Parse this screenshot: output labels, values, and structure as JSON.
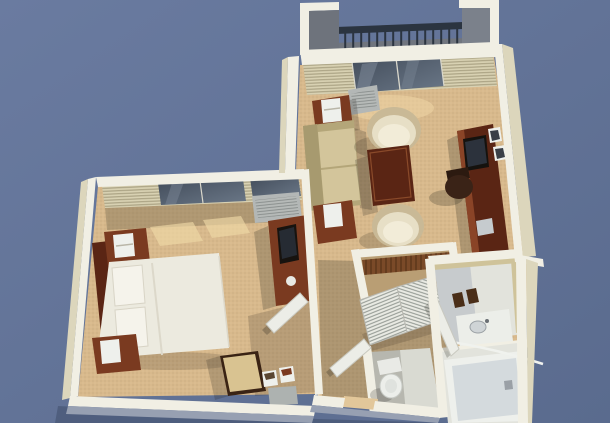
{
  "scene": {
    "type": "3d-floorplan-render",
    "description": "Bird's-eye 3D rendering of a one-bedroom suite floor plan on a blue-gray background",
    "rooms": [
      {
        "name": "balcony",
        "items": [
          "metal railing",
          "side pillars"
        ]
      },
      {
        "name": "living-room",
        "items": [
          "sofa",
          "end table with lamp (x2)",
          "barrel chair (x2)",
          "wood table",
          "media console",
          "tv",
          "desk chair",
          "wall art (x2)",
          "ptac unit",
          "sliding glass door",
          "vertical blinds"
        ]
      },
      {
        "name": "bedroom",
        "items": [
          "bed with white bedding",
          "pillows",
          "headboard",
          "nightstand with lamp (x2)",
          "dresser",
          "tv",
          "ice bucket",
          "ptac unit",
          "windows with blinds",
          "luggage bench",
          "bins",
          "door"
        ]
      },
      {
        "name": "closet",
        "items": [
          "louvered bifold doors",
          "shelf with hangers"
        ]
      },
      {
        "name": "hallway",
        "items": [
          "entry door"
        ]
      },
      {
        "name": "bathroom",
        "items": [
          "vanity counter",
          "sink",
          "bath mats",
          "shower rod",
          "bathtub",
          "tub faucet",
          "toilet",
          "door"
        ]
      }
    ],
    "palette": {
      "skyTop": "#6A7BA0",
      "skyBottom": "#5A6B8E",
      "carpet": "#D8B98C",
      "wallWhite": "#F1EFE4",
      "wallCream": "#DCD6BC",
      "wallShadowBlue": "#97A0B2",
      "wallTan": "#CFC39A",
      "woodDark": "#5A2514",
      "woodMid": "#7A3A20",
      "bedding": "#ECEADF",
      "cream": "#E7DFC6",
      "sofa": "#D3C59B",
      "sofaShade": "#B4A679",
      "railDark": "#2B3440",
      "balconyGray": "#70757E",
      "glassDark": "#424C5A",
      "acGray": "#B3B7B6",
      "tileLight": "#E2E3DC",
      "tileShade": "#B9BEC4",
      "fixtureWhite": "#EEF0EC",
      "doorWhite": "#ECEDE7"
    }
  }
}
